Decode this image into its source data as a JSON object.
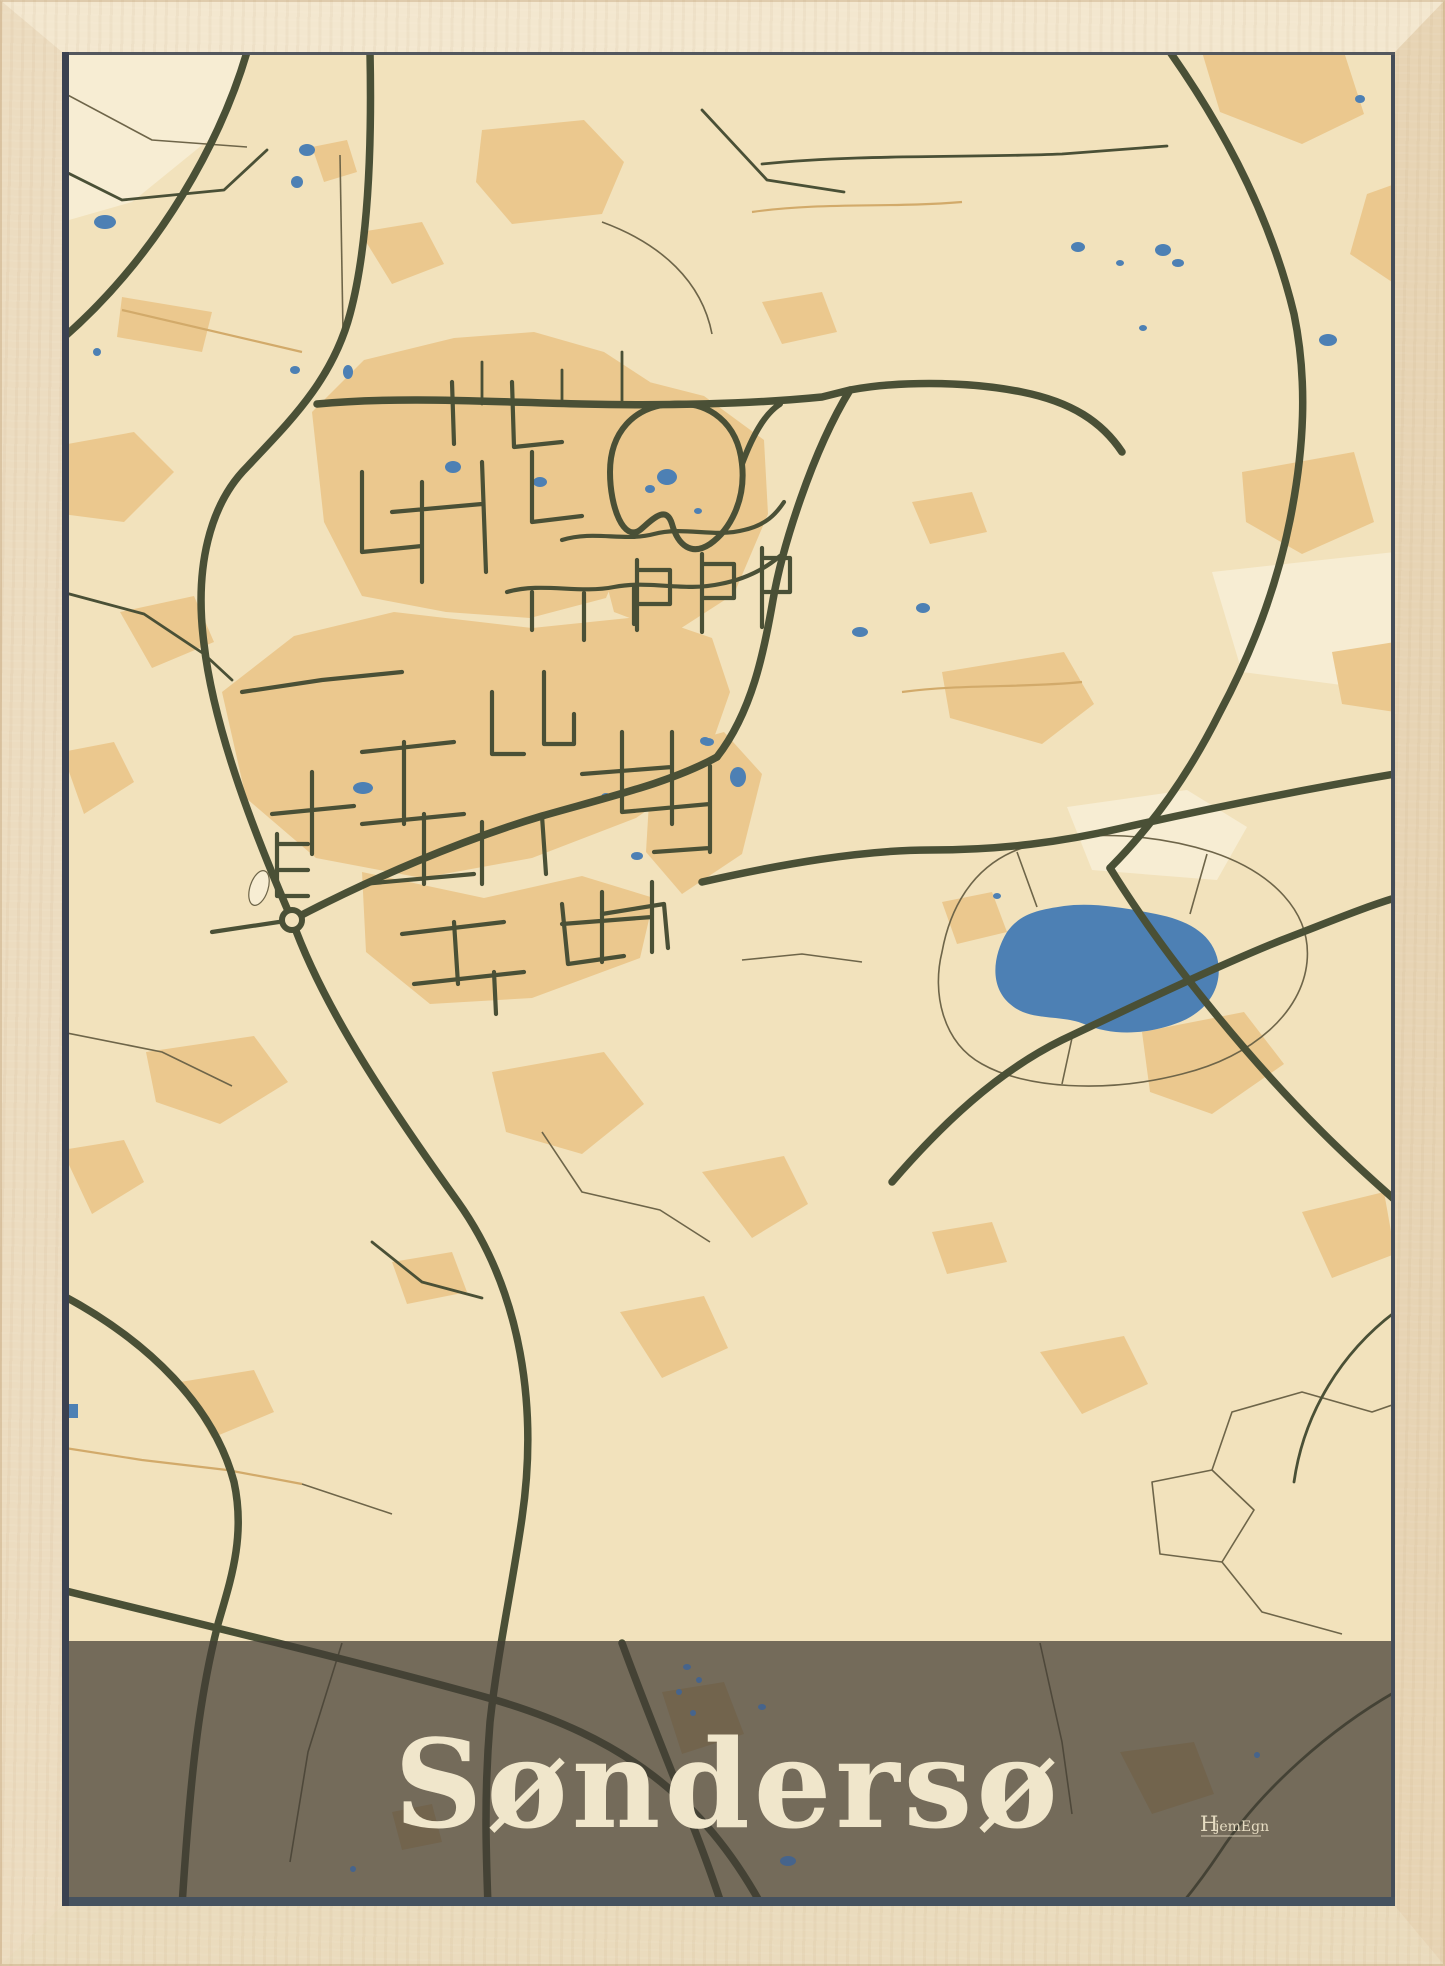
{
  "poster": {
    "title": "Søndersø",
    "brand": {
      "initial": "H",
      "rest": "jemEgn",
      "full": "HjemEgn"
    }
  },
  "map": {
    "style": "flat vintage street map",
    "features": {
      "large_lake": "right of center",
      "town_core": "dense olive street grid on tan ground, left of center",
      "roundabout": "west edge of town core",
      "loop_road_with_ponds": "north-east of town core",
      "title_band": "translucent dark band across bottom with map showing through"
    }
  },
  "theme": {
    "wood_top": "#f3e7cf",
    "wood_left": "#ecdcc0",
    "wood_right": "#e7d4b4",
    "wood_bottom": "#eadbbd",
    "map_cream": "#f2e2bc",
    "map_tan": "#ebc88e",
    "map_pale": "#f7edd3",
    "water_blue": "#4d80b4",
    "road_olive": "#4a5036",
    "thin_brown": "#6e6549",
    "field_path_tan": "#d2aa6a",
    "band_overlay": "rgba(66,61,52,0.72)",
    "band_dot": "#46648c",
    "title_cream": "#f0e6cb",
    "shadow_left": "#3a4150",
    "shadow_bottom": "#46525f",
    "shadow_top": "#53575d",
    "shadow_right": "#454d58"
  }
}
